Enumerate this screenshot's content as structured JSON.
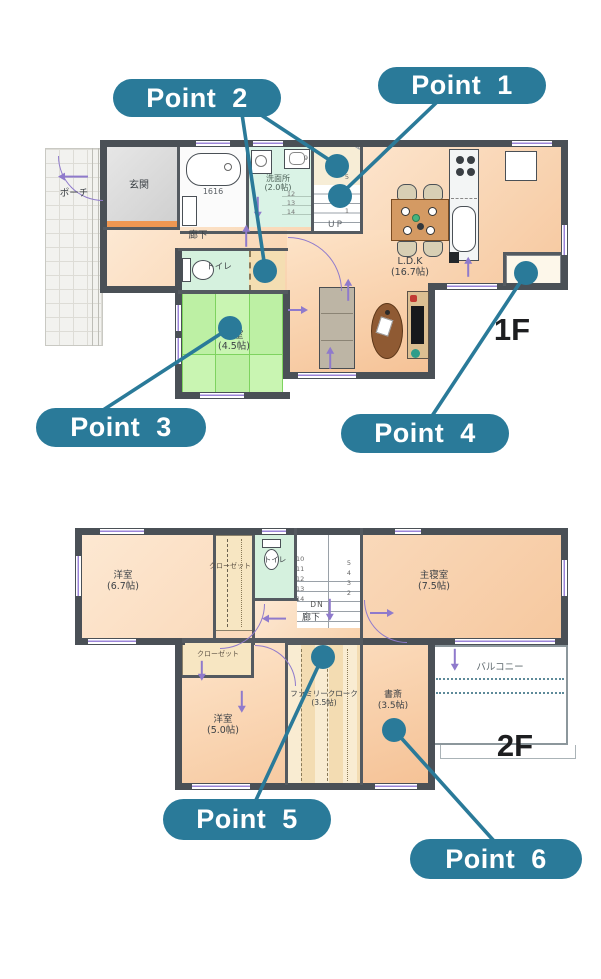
{
  "accent_color": "#2a7a99",
  "wall_color": "#4a5056",
  "tatami_color": "#bdf0a4",
  "floor_color": "#f8cfa8",
  "points": [
    {
      "label": "Point 1"
    },
    {
      "label": "Point 2"
    },
    {
      "label": "Point 3"
    },
    {
      "label": "Point 4"
    },
    {
      "label": "Point 5"
    },
    {
      "label": "Point 6"
    }
  ],
  "floor1": {
    "tag": "1F",
    "rooms": {
      "porch": "ポーチ",
      "genkan": "玄関",
      "bath_size": "1616",
      "wash": "洗面所",
      "wash_size": "(2.0帖)",
      "hall": "廊下",
      "toilet": "トイレ",
      "washitsu": "和室",
      "washitsu_size": "(4.5帖)",
      "ldk": "L.D.K",
      "ldk_size": "(16.7帖)"
    },
    "stairs": {
      "up": "UP",
      "n9": "9",
      "col": [
        "5",
        "2",
        "1"
      ],
      "over": [
        "12",
        "13",
        "14"
      ]
    }
  },
  "floor2": {
    "tag": "2F",
    "rooms": {
      "west1": "洋室",
      "west1_size": "(6.7帖)",
      "closet1": "クローゼット",
      "toilet": "トイレ",
      "master": "主寝室",
      "master_size": "(7.5帖)",
      "balcony": "バルコニー",
      "study": "書斎",
      "study_size": "(3.5帖)",
      "cloak": "ファミリークローク",
      "cloak_size": "(3.5帖)",
      "west2": "洋室",
      "west2_size": "(5.0帖)",
      "closet2": "クローゼット",
      "hall": "廊下"
    },
    "stairs": {
      "dn": "DN",
      "left": [
        "10",
        "11",
        "12",
        "13",
        "14"
      ],
      "right": [
        "5",
        "4",
        "3",
        "2"
      ]
    }
  }
}
